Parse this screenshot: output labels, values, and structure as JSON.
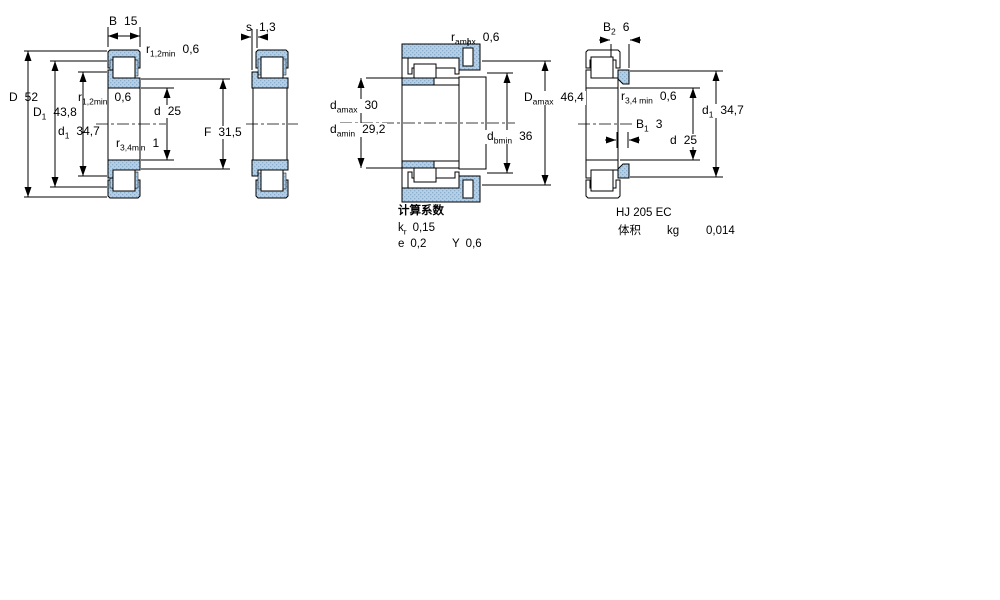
{
  "colors": {
    "section_fill": "#b5cfe6",
    "section_dot": "#8aaecb",
    "line_color": "#000000"
  },
  "drawing1": {
    "labels": {
      "B": {
        "sym": "B",
        "val": "15"
      },
      "r12_top": {
        "sym": "r",
        "sub": "1,2min",
        "val": "0,6"
      },
      "D": {
        "sym": "D",
        "val": "52"
      },
      "D1": {
        "sym": "D",
        "sub": "1",
        "val": "43,8"
      },
      "d1": {
        "sym": "d",
        "sub": "1",
        "val": "34,7"
      },
      "r12_mid": {
        "sym": "r",
        "sub": "1,2min",
        "val": "0,6"
      },
      "d": {
        "sym": "d",
        "val": "25"
      },
      "r34": {
        "sym": "r",
        "sub": "3,4min",
        "val": "1"
      },
      "F": {
        "sym": "F",
        "val": "31,5"
      }
    }
  },
  "drawing2": {
    "labels": {
      "s": {
        "sym": "s",
        "val": "1,3"
      }
    }
  },
  "drawing3": {
    "labels": {
      "ramax": {
        "sym": "r",
        "sub": "amax",
        "val": "0,6"
      },
      "damax": {
        "sym": "d",
        "sub": "amax",
        "val": "30"
      },
      "damin": {
        "sym": "d",
        "sub": "amin",
        "val": "29,2"
      },
      "Damax": {
        "sym": "D",
        "sub": "amax",
        "val": "46,4"
      },
      "dbmin": {
        "sym": "d",
        "sub": "bmin",
        "val": "36"
      }
    }
  },
  "drawing4": {
    "labels": {
      "B2": {
        "sym": "B",
        "sub": "2",
        "val": "6"
      },
      "r34min": {
        "sym": "r",
        "sub": "3,4 min",
        "val": "0,6"
      },
      "B1": {
        "sym": "B",
        "sub": "1",
        "val": "3"
      },
      "d": {
        "sym": "d",
        "val": "25"
      },
      "d1": {
        "sym": "d",
        "sub": "1",
        "val": "34,7"
      }
    }
  },
  "calc_factors": {
    "title": "计算系数",
    "kr": {
      "sym": "k",
      "sub": "r",
      "val": "0,15"
    },
    "e": {
      "sym": "e",
      "val": "0,2"
    },
    "Y": {
      "sym": "Y",
      "val": "0,6"
    }
  },
  "product": {
    "designation": "HJ 205 EC",
    "volume_label": "体积",
    "volume_unit": "kg",
    "volume_value": "0,014"
  }
}
